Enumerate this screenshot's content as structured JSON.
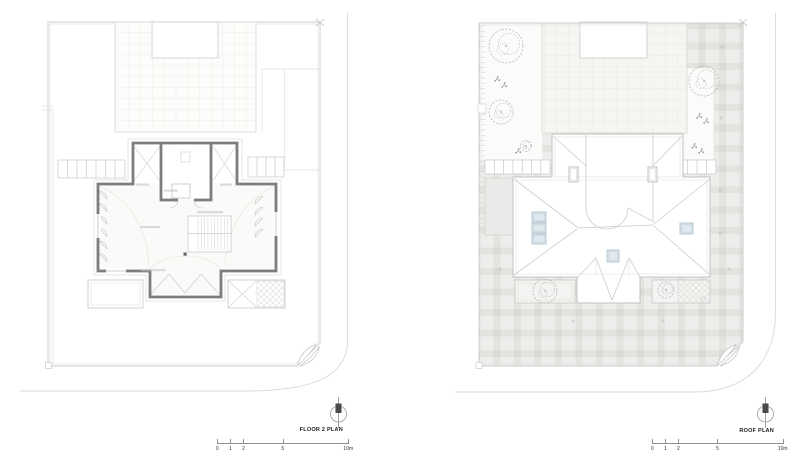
{
  "plans": [
    {
      "id": "floor2",
      "title": "FLOOR 2 PLAN"
    },
    {
      "id": "roof",
      "title": "ROOF PLAN"
    }
  ],
  "scale_bar": {
    "marks": [
      {
        "m": 0,
        "label": "0"
      },
      {
        "m": 1,
        "label": "1"
      },
      {
        "m": 2,
        "label": "2"
      },
      {
        "m": 5,
        "label": "5"
      },
      {
        "m": 10,
        "label": "10m"
      }
    ]
  },
  "symbols": {
    "north_arrow": "north-arrow",
    "gate_swing": "gate-swing",
    "tree": "tree-scribble"
  },
  "colors": {
    "background": "#ffffff",
    "wall": "#7d7d7d",
    "site_line": "#cdcdcd",
    "thin_line": "#cccccc",
    "curb_line": "#dadada",
    "plaid_base": "#eeedeb",
    "plaid_band": "#e4e3e0",
    "skylight_fill": "#dfe9ef",
    "skylight_stroke": "#a9bcc7",
    "tree_stroke": "#b4b4b4",
    "label_text": "#1c1c1c"
  },
  "floor2_plan": {
    "label_smudges": [
      {
        "x": 136,
        "y": 183.5,
        "w": 13
      },
      {
        "x": 220,
        "y": 183.5,
        "w": 12
      },
      {
        "x": 164,
        "y": 189.5,
        "w": 14
      },
      {
        "x": 140,
        "y": 226,
        "w": 20
      },
      {
        "x": 141,
        "y": 269,
        "w": 25
      },
      {
        "x": 197,
        "y": 211,
        "w": 26
      }
    ]
  },
  "roof_plan": {
    "trees": {
      "garden_left": [
        {
          "x": 506,
          "y": 46,
          "r": 17
        },
        {
          "x": 497,
          "y": 79,
          "r": 4.5
        },
        {
          "x": 504,
          "y": 85,
          "r": 3
        },
        {
          "x": 501,
          "y": 112,
          "r": 12
        },
        {
          "x": 526,
          "y": 146,
          "r": 5.5
        },
        {
          "x": 518,
          "y": 151,
          "r": 3
        }
      ],
      "garden_right": [
        {
          "x": 704,
          "y": 81,
          "r": 15
        },
        {
          "x": 699,
          "y": 116,
          "r": 4.5
        },
        {
          "x": 706,
          "y": 121,
          "r": 3
        },
        {
          "x": 694,
          "y": 146,
          "r": 4.5
        },
        {
          "x": 701,
          "y": 151,
          "r": 3
        }
      ],
      "planters": [
        {
          "x": 545,
          "y": 291,
          "r": 12
        },
        {
          "x": 666,
          "y": 290,
          "r": 8
        }
      ]
    },
    "skylights": [
      {
        "x": 569,
        "y": 167,
        "w": 9,
        "h": 15,
        "fill": "#ffffff",
        "stroke": "#b0b0b0",
        "inner": true
      },
      {
        "x": 648,
        "y": 167,
        "w": 9,
        "h": 15,
        "fill": "#ffffff",
        "stroke": "#b0b0b0",
        "inner": true
      },
      {
        "x": 532,
        "y": 212,
        "w": 14,
        "h": 10,
        "fill": "#dfe9ef",
        "stroke": "#a9bcc7",
        "inner": true
      },
      {
        "x": 532,
        "y": 223,
        "w": 14,
        "h": 10,
        "fill": "#dfe9ef",
        "stroke": "#a9bcc7",
        "inner": true
      },
      {
        "x": 532,
        "y": 234,
        "w": 14,
        "h": 10,
        "fill": "#dfe9ef",
        "stroke": "#a9bcc7",
        "inner": true
      },
      {
        "x": 680,
        "y": 223,
        "w": 13,
        "h": 11,
        "fill": "#dfe9ef",
        "stroke": "#a9bcc7",
        "inner": true
      },
      {
        "x": 607,
        "y": 250,
        "w": 12,
        "h": 12,
        "fill": "#dfe9ef",
        "stroke": "#a9bcc7",
        "inner": true
      }
    ],
    "plus_marks": [
      {
        "x": 722,
        "y": 47
      },
      {
        "x": 721,
        "y": 118
      },
      {
        "x": 720,
        "y": 190
      },
      {
        "x": 720,
        "y": 233
      },
      {
        "x": 500,
        "y": 269
      },
      {
        "x": 729,
        "y": 269
      },
      {
        "x": 573,
        "y": 321
      },
      {
        "x": 663,
        "y": 321
      }
    ],
    "ruler": {
      "x0": 479,
      "x1": 485.5,
      "y0": 26,
      "y1": 233,
      "step": 5.2
    }
  }
}
